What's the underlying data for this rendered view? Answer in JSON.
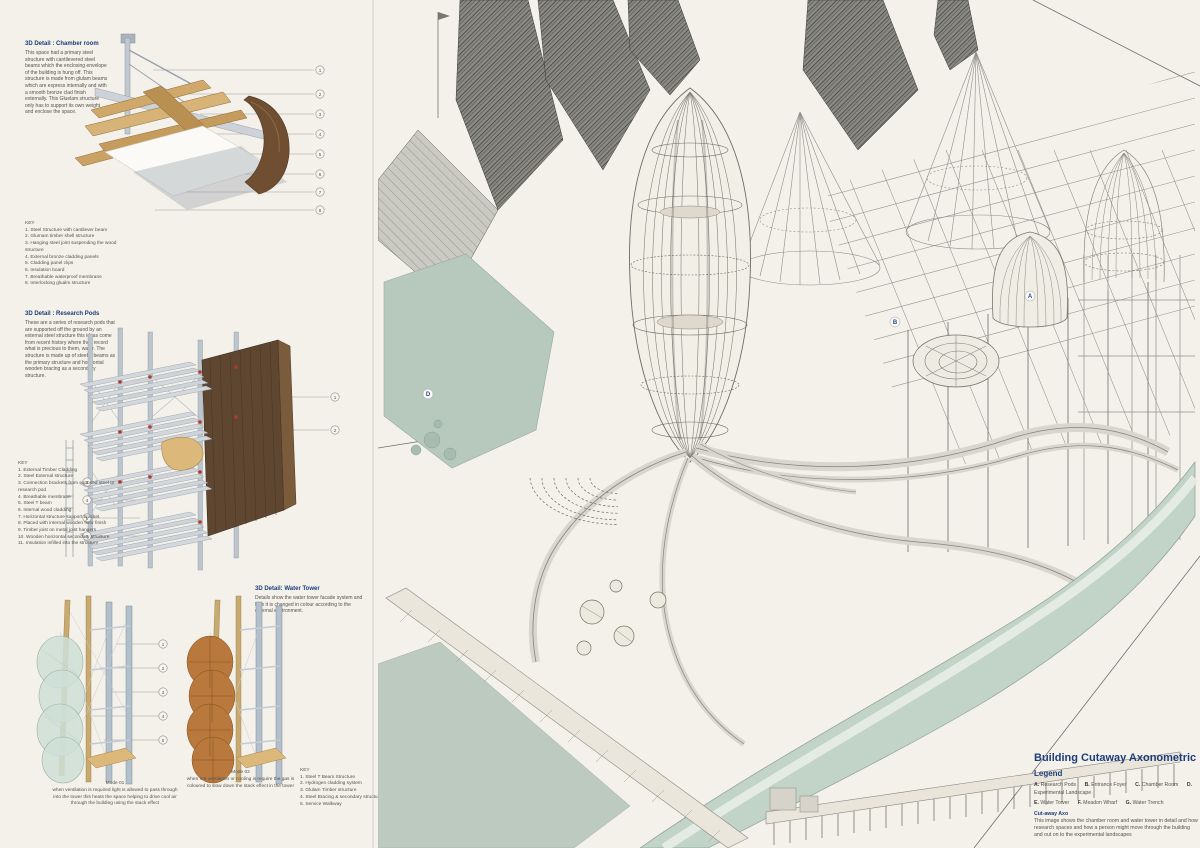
{
  "board": {
    "details": {
      "chamber": {
        "title": "3D Detail : Chamber room",
        "body": "This space had a primary steel structure with cantilevered steel beams which the enclosing envelope of the building is hung off. This structure is made from glulam beams which are express internally and with a smooth bronze clad finish externally. This Gluelam structure only has to support its own weight and enclose the space.",
        "key_title": "KEY",
        "key": [
          "1. Steel Structure with cantilever beam",
          "2. Glumam timber shell structure",
          "3. Hanging steel joint suspending the wood structure",
          "4. External bronze cladding panels",
          "5. Cladding panel clips",
          "6. Insulation board",
          "7. Breathable waterproof membrane",
          "8. Interlocking glualm structure"
        ],
        "callouts": [
          "1",
          "2",
          "3",
          "4",
          "5",
          "6",
          "7",
          "8"
        ]
      },
      "research": {
        "title": "3D Detail : Research Pods",
        "body": "These are a series of research pods that are supported off the ground by an external steel structure this ideas come from recent history where they record what is precious to them, water. The structure is made up of steel T beams as the primary structure and horizontal wooden bracing as a secondary structure.",
        "key_title": "KEY",
        "key": [
          "1. External Timber Cladding",
          "2. Steel External structure",
          "3. Connection brackets from exposed steel to research pod",
          "4. Breathable membrane",
          "5. Steel T beam",
          "6. Internal wood cladding",
          "7. Horizontal structure support bracket",
          "8. Placed with internal wooden floor finish",
          "9. Timber joist on metal joist hangers",
          "10. Wooden horizontal secondary structure",
          "11. Insulation infilled into the structure"
        ],
        "callouts": [
          "1",
          "2",
          "3",
          "4",
          "5",
          "6"
        ]
      },
      "water_tower": {
        "title": "3D Detail: Water Tower",
        "body": "Details show the water tower facade system and how it is changed in colour according to the external environment.",
        "key_title": "KEY",
        "key": [
          "1. Steel T Beam Structure",
          "2. Hydrogen cladding system",
          "3. Glulam Timber structure",
          "4. Steel Bracing & secondary structure",
          "5. Service Walkway"
        ],
        "callouts": [
          "1",
          "2",
          "3",
          "4",
          "5"
        ],
        "mode1_title": "Mode 01",
        "mode1_body": "when ventilation is required light is allowed to pass through into the tower this heats the space helping to drive cool air through the building using the stack effect",
        "mode2_title": "Mode 02",
        "mode2_body": "when not ventilation or cooling is require the gas is coloured to slow down the stack effect in the tower"
      }
    },
    "axon": {
      "markers": [
        {
          "letter": "A"
        },
        {
          "letter": "B"
        },
        {
          "letter": "D"
        }
      ],
      "info": {
        "title": "Building Cutaway Axonometric",
        "legend_title": "Legend",
        "legend": [
          {
            "letter": "A.",
            "label": "Research Pods"
          },
          {
            "letter": "B.",
            "label": "Entrance Foyer"
          },
          {
            "letter": "C.",
            "label": "Chamber Room"
          },
          {
            "letter": "D.",
            "label": "Experimental Landscape"
          },
          {
            "letter": "E.",
            "label": "Water Tower"
          },
          {
            "letter": "F.",
            "label": "Meadon Wharf"
          },
          {
            "letter": "G.",
            "label": "Water Trench"
          }
        ],
        "caption_title": "Cut-away Axo",
        "caption_body": "This image shows the chamber room and water tower in detail and how research spaces and how a person might move through the building and out on to the experimental landscapes"
      }
    },
    "colors": {
      "paper": "#f4f1ea",
      "heading_blue": "#1d3d7a",
      "sage_green": "#b7c8bc",
      "trench_green": "#c2d3c8",
      "wood_tan": "#c9a76b",
      "walnut": "#5e4630",
      "bronze": "#6f4e31",
      "steel": "#b9c2cc",
      "accent_red": "#b23b2f"
    }
  }
}
